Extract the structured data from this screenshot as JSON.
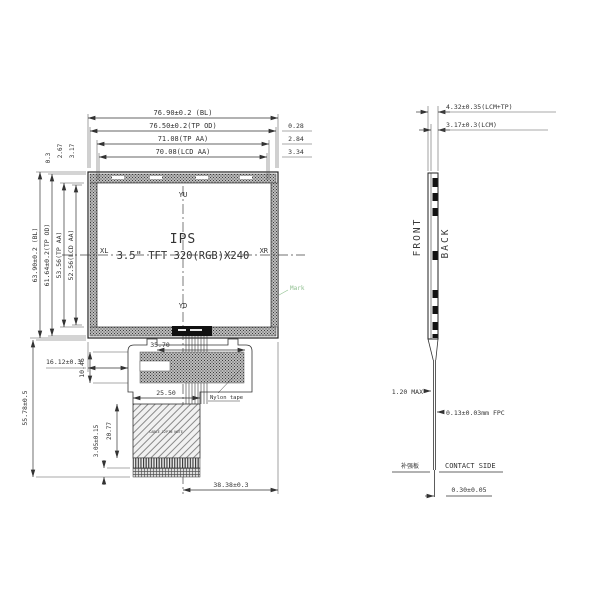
{
  "front": {
    "dims_top": {
      "bl": "76.90±0.2 (BL)",
      "tp_od": "76.50±0.2(TP OD)",
      "tp_aa": "71.08(TP AA)",
      "lcd_aa": "70.08(LCD AA)"
    },
    "dims_right": {
      "d1": "0.28",
      "d2": "2.84",
      "d3": "3.34"
    },
    "dims_left": {
      "bl": "63.90±0.2 (BL)",
      "tp_od": "61.64±0.2(TP OD)",
      "tp_aa": "53.56(TP AA)",
      "lcd_aa": "52.56(LCD AA)"
    },
    "dims_top_left": {
      "d1": "0.3",
      "d2": "2.67",
      "d3": "3.17"
    },
    "center": {
      "yu": "YU",
      "yd": "YD",
      "xl": "XL",
      "xr": "XR",
      "line1": "IPS",
      "line2": "3.5\" TFT 320(RGB)X240"
    },
    "mark_label": "Mark",
    "fpc": {
      "dim_width_top": "35.70",
      "dim_height_left": "10.46",
      "dim_offset_left": "16.12±0.3",
      "dim_total_height": "55.78±0.5",
      "dim_stiffener_width": "25.50",
      "dim_stiffener_height": "20.77",
      "dim_comb": "3.05±0.15",
      "dim_bottom": "38.38±0.3",
      "tape_label": "Nylon tape",
      "stiffener_note": "CABLE 12PIN NOTE"
    }
  },
  "side": {
    "front_label": "FRONT",
    "back_label": "BACK",
    "dim_total": "4.32±0.35(LCM+TP)",
    "dim_lcm": "3.17±0.3(LCM)",
    "dim_bend": "1.20 MAX",
    "dim_fpc": "0.13±0.03mm FPC",
    "stiffener_label": "补强板",
    "contact_label": "CONTACT SIDE",
    "dim_thickness": "0.30±0.05"
  },
  "colors": {
    "line": "#333333",
    "mark_green": "#8fbf8f"
  }
}
